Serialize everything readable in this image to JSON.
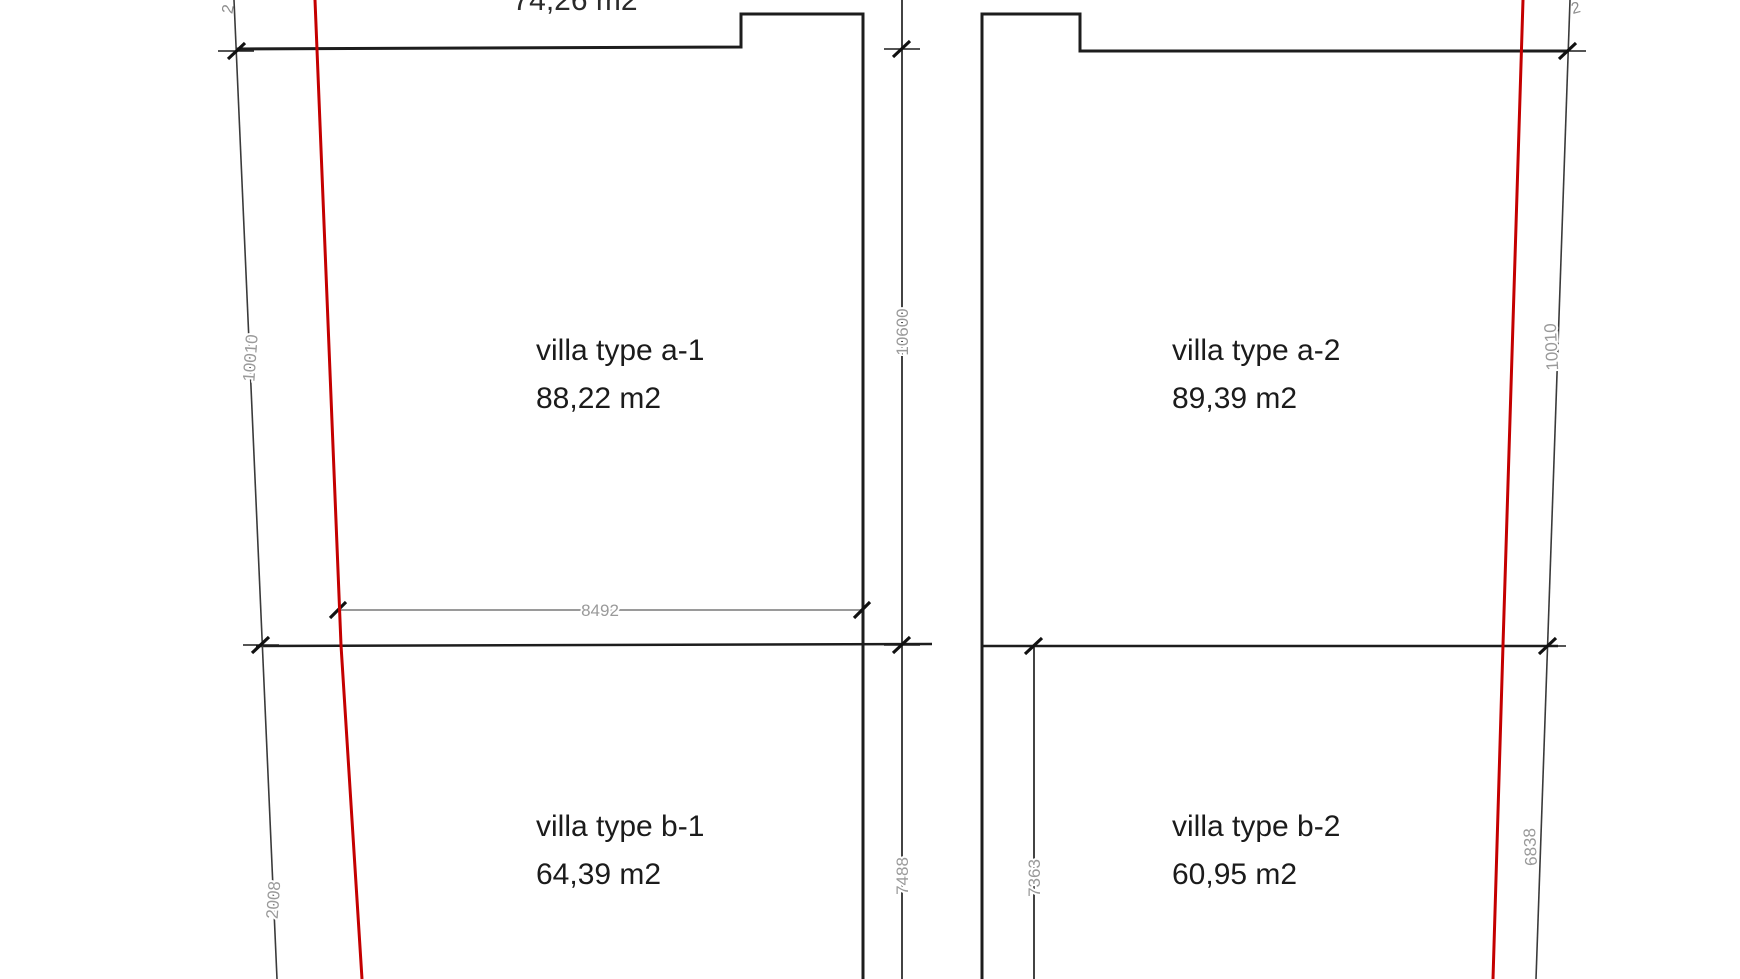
{
  "drawing": {
    "top_area_label_clipped": "74,26 m2",
    "top_left_partial_label": "2",
    "top_right_partial_label": "2",
    "left_plot": {
      "upper_unit": {
        "name": "villa type a-1",
        "area": "88,22 m2"
      },
      "lower_unit": {
        "name": "villa type b-1",
        "area": "64,39 m2"
      },
      "dimensions": {
        "left_boundary_upper": "10010",
        "left_boundary_lower": "2008",
        "upper_width": "8492",
        "right_upper_height": "10600",
        "right_lower_height": "7488"
      }
    },
    "right_plot": {
      "upper_unit": {
        "name": "villa type a-2",
        "area": "89,39 m2"
      },
      "lower_unit": {
        "name": "villa type b-2",
        "area": "60,95 m2"
      },
      "dimensions": {
        "lower_left_height": "7363",
        "right_boundary_upper": "10010",
        "right_boundary_lower": "6838"
      }
    },
    "colors": {
      "background": "#ffffff",
      "outline": "#1d1d1d",
      "dimension_gray": "#9a9a9a",
      "boundary_red": "#c40000"
    }
  }
}
